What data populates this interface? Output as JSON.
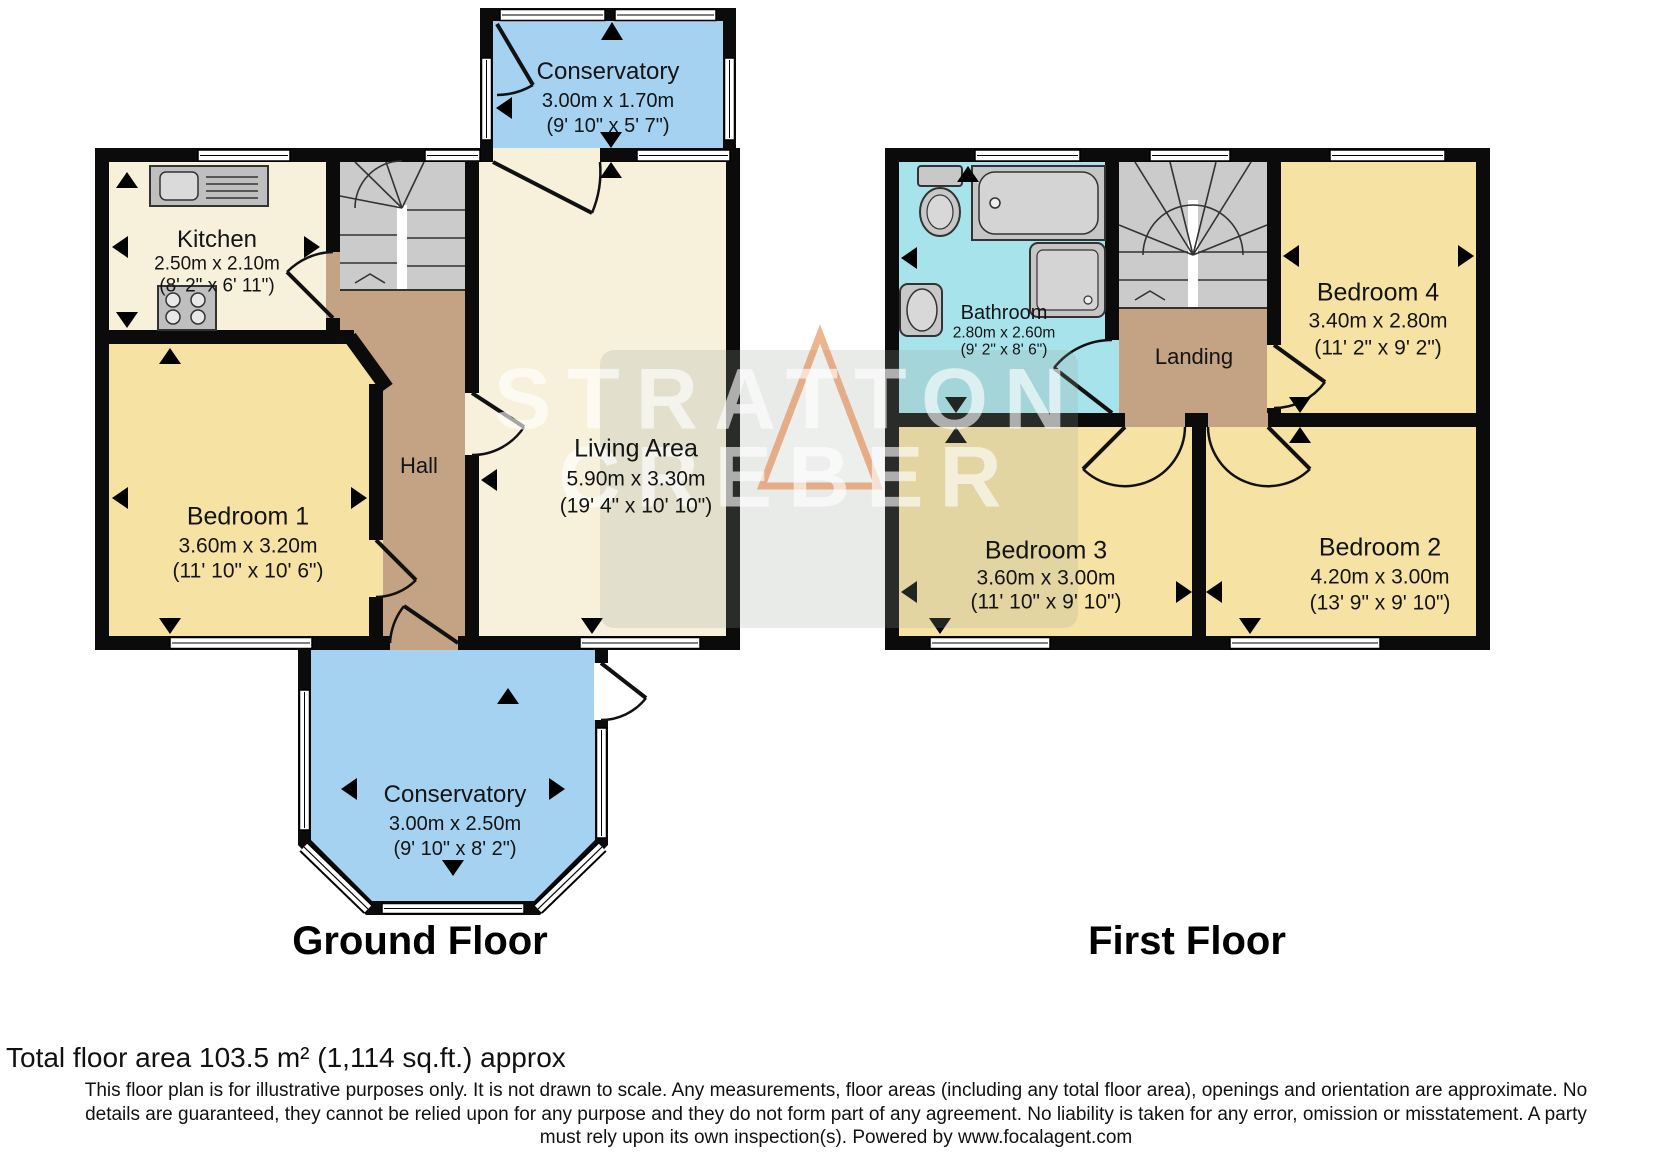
{
  "watermark": {
    "line1": "STRATTON",
    "line2": "CREBER"
  },
  "ground_floor": {
    "floor_label": "Ground Floor",
    "conservatory_top": {
      "name": "Conservatory",
      "dims_metric": "3.00m x 1.70m",
      "dims_imperial": "(9' 10\" x 5' 7\")"
    },
    "kitchen": {
      "name": "Kitchen",
      "dims_metric": "2.50m x 2.10m",
      "dims_imperial": "(8' 2\" x 6' 11\")"
    },
    "hall": {
      "name": "Hall"
    },
    "living_area": {
      "name": "Living Area",
      "dims_metric": "5.90m x 3.30m",
      "dims_imperial": "(19' 4\" x 10' 10\")"
    },
    "bedroom_1": {
      "name": "Bedroom 1",
      "dims_metric": "3.60m x 3.20m",
      "dims_imperial": "(11' 10\" x 10' 6\")"
    },
    "conservatory_bottom": {
      "name": "Conservatory",
      "dims_metric": "3.00m x 2.50m",
      "dims_imperial": "(9' 10\" x 8' 2\")"
    }
  },
  "first_floor": {
    "floor_label": "First Floor",
    "bathroom": {
      "name": "Bathroom",
      "dims_metric": "2.80m x 2.60m",
      "dims_imperial": "(9' 2\" x 8' 6\")"
    },
    "landing": {
      "name": "Landing"
    },
    "bedroom_4": {
      "name": "Bedroom 4",
      "dims_metric": "3.40m x 2.80m",
      "dims_imperial": "(11' 2\" x 9' 2\")"
    },
    "bedroom_3": {
      "name": "Bedroom 3",
      "dims_metric": "3.60m x 3.00m",
      "dims_imperial": "(11' 10\" x 9' 10\")"
    },
    "bedroom_2": {
      "name": "Bedroom 2",
      "dims_metric": "4.20m x 3.00m",
      "dims_imperial": "(13' 9\" x 9' 10\")"
    }
  },
  "footer": {
    "total_area": "Total floor area 103.5 m² (1,114 sq.ft.) approx",
    "disclaimer_line_1": "This floor plan is for illustrative purposes only. It is not drawn to scale. Any measurements, floor areas (including any total floor area), openings and orientation are approximate. No",
    "disclaimer_line_2": "details are guaranteed, they cannot be relied upon for any purpose and they do not form part of any agreement. No liability is taken for any error, omission or misstatement. A party",
    "disclaimer_line_3": "must rely upon its own inspection(s). Powered by www.focalagent.com"
  },
  "colors": {
    "room_cream": "#F7F1DB",
    "room_yellow": "#F6E3A3",
    "conservatory_blue": "#A5D2F1",
    "bathroom_cyan": "#A6E3EB",
    "hall_brown": "#C3A383",
    "stairs_grey": "#CBCBCB",
    "wall_black": "#0B0B0B",
    "watermark_orange": "#E07B39"
  }
}
